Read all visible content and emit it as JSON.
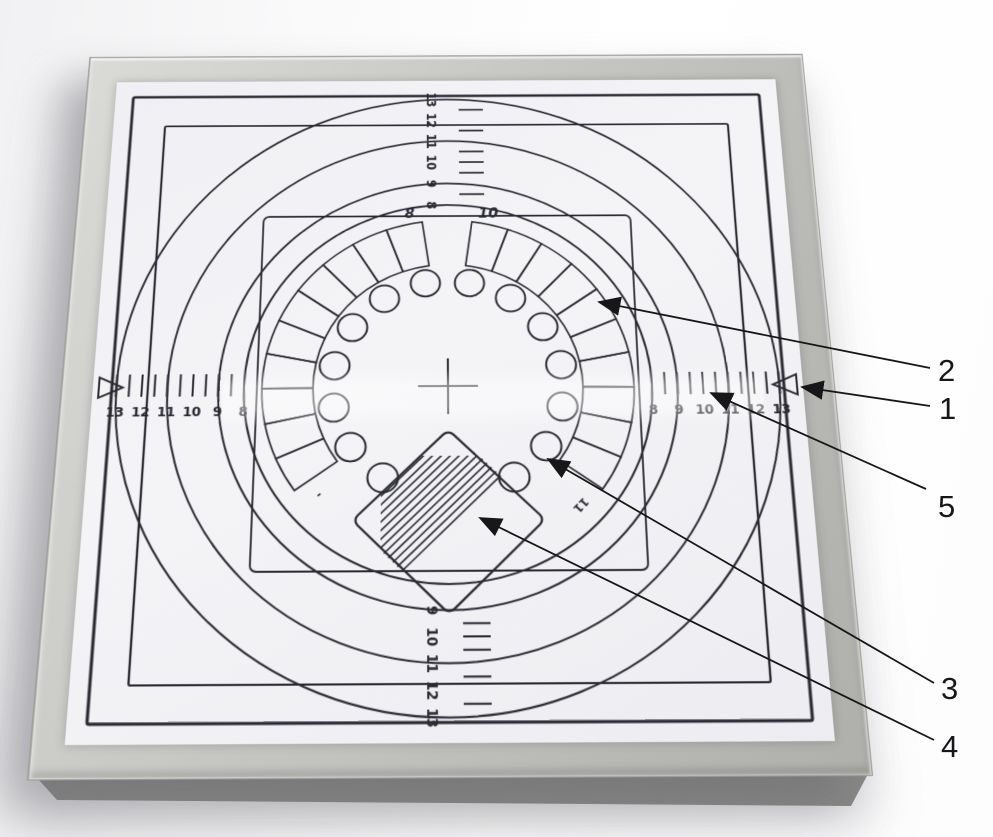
{
  "scales": {
    "left": [
      "13",
      "12",
      "11",
      "10",
      "9",
      "8"
    ],
    "right": [
      "8",
      "9",
      "10",
      "11",
      "12",
      "13"
    ],
    "top": [
      "13",
      "12",
      "11",
      "10",
      "9",
      "8"
    ],
    "bottom": [
      "9",
      "10",
      "11",
      "12",
      "13"
    ]
  },
  "wedge_ring": {
    "left_arc_label": "8",
    "right_arc_label": "10",
    "left_arc_end_label": "-",
    "right_arc_end_label": "11"
  },
  "callouts": [
    {
      "label": "2"
    },
    {
      "label": "1"
    },
    {
      "label": "5"
    },
    {
      "label": "3"
    },
    {
      "label": "4"
    }
  ],
  "colors": {
    "ink": "#2a2a33",
    "annotation": "#17171a",
    "paper": "#f4f4f7",
    "frame_light": "#dadad6",
    "frame_dark": "#afafab"
  }
}
